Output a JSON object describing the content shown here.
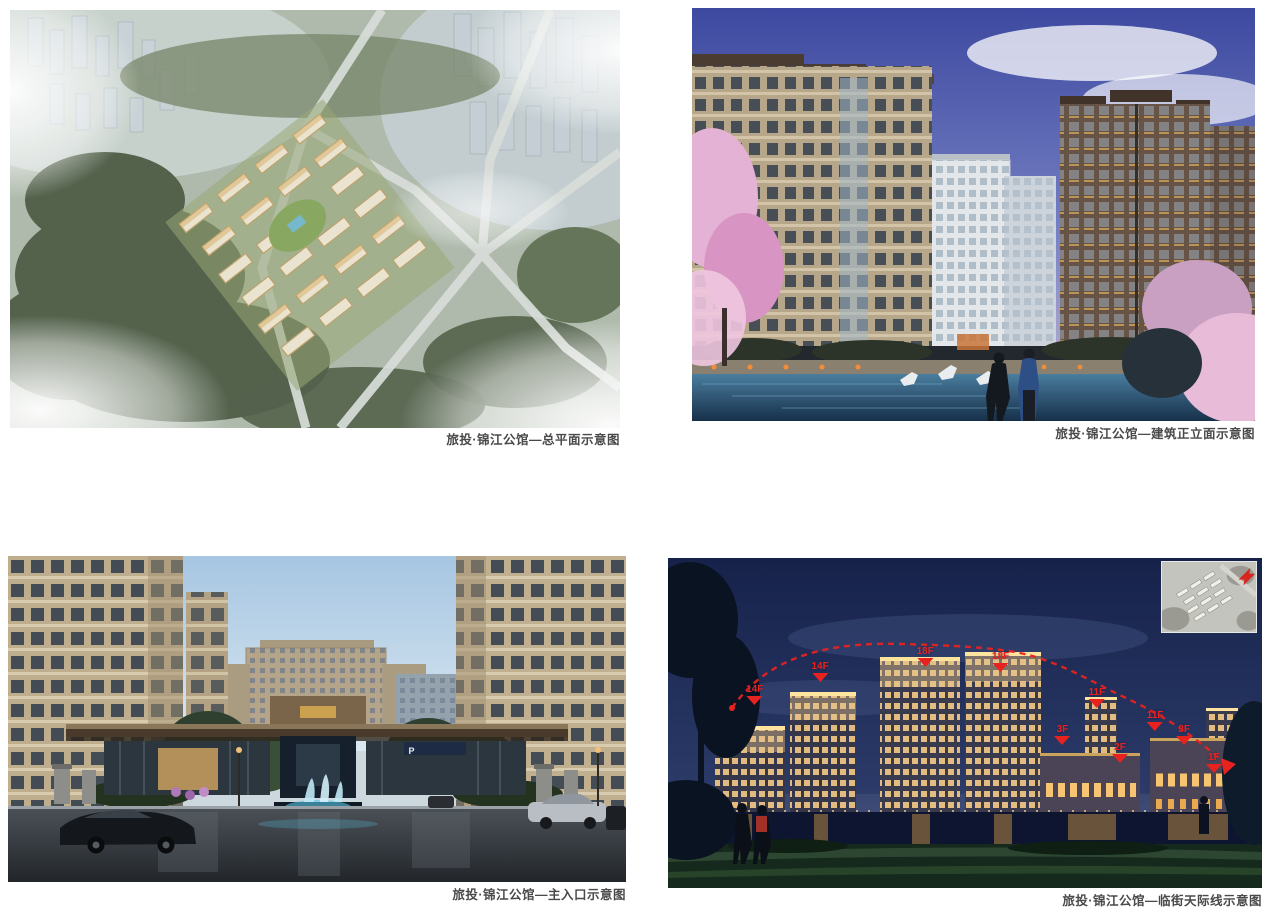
{
  "project_name": "旅投·锦江公馆",
  "figures": [
    {
      "name": "site-plan",
      "caption": "旅投·锦江公馆—总平面示意图"
    },
    {
      "name": "front-elevation",
      "caption": "旅投·锦江公馆—建筑正立面示意图"
    },
    {
      "name": "main-entrance",
      "caption": "旅投·锦江公馆—主入口示意图",
      "parking_sign": "P"
    },
    {
      "name": "street-skyline",
      "caption": "旅投·锦江公馆—临街天际线示意图",
      "annotation_color": "#e8231f",
      "floor_labels": [
        "14F",
        "14F",
        "18F",
        "18F",
        "11F",
        "3F",
        "2F",
        "11F",
        "3F",
        "1F"
      ]
    }
  ]
}
